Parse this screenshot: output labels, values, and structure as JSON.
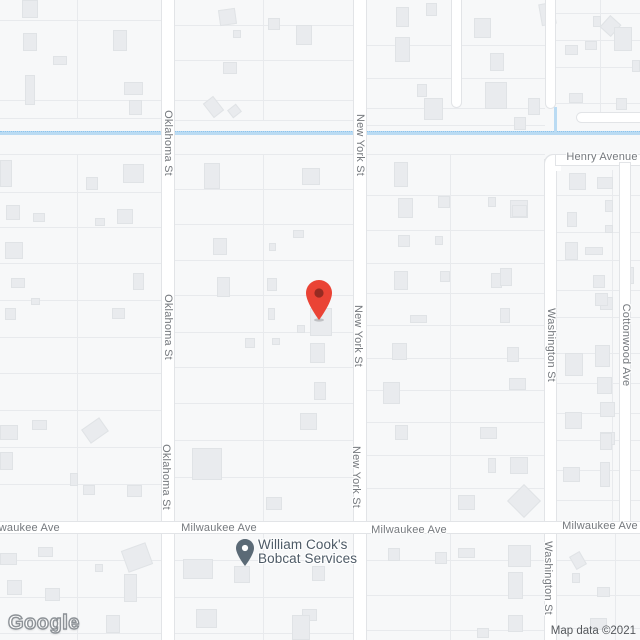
{
  "map": {
    "watermark": "Google",
    "attribution": "Map data ©2021",
    "colors": {
      "marker": "#ea4335",
      "marker_core": "#962b22",
      "poi_pin": "#5b6a76",
      "water": "#badbf3",
      "street_label": "#75797e",
      "poi_text": "#4d5a66"
    },
    "poi": {
      "line1": "William Cook's",
      "line2": "Bobcat Services"
    },
    "street_labels": [
      {
        "text": "Oklahoma St",
        "x": 168,
        "y": 143,
        "rot": 90
      },
      {
        "text": "Oklahoma St",
        "x": 168,
        "y": 327,
        "rot": 90
      },
      {
        "text": "Oklahoma St",
        "x": 166,
        "y": 477,
        "rot": 90
      },
      {
        "text": "New York St",
        "x": 360,
        "y": 145,
        "rot": 90
      },
      {
        "text": "New York St",
        "x": 358,
        "y": 336,
        "rot": 90
      },
      {
        "text": "New York St",
        "x": 356,
        "y": 477,
        "rot": 90
      },
      {
        "text": "Washington St",
        "x": 551,
        "y": 345,
        "rot": 90
      },
      {
        "text": "Washington St",
        "x": 548,
        "y": 578,
        "rot": 90
      },
      {
        "text": "Cottonwood Ave",
        "x": 626,
        "y": 345,
        "rot": 90
      },
      {
        "text": "Henry Avenue",
        "x": 602,
        "y": 157,
        "rot": 0
      },
      {
        "text": "Milwaukee Ave",
        "x": 22,
        "y": 528,
        "rot": 0
      },
      {
        "text": "Milwaukee Ave",
        "x": 219,
        "y": 528,
        "rot": 0
      },
      {
        "text": "Milwaukee Ave",
        "x": 409,
        "y": 530,
        "rot": 0
      },
      {
        "text": "Milwaukee Ave",
        "x": 600,
        "y": 526,
        "rot": 0
      }
    ]
  }
}
